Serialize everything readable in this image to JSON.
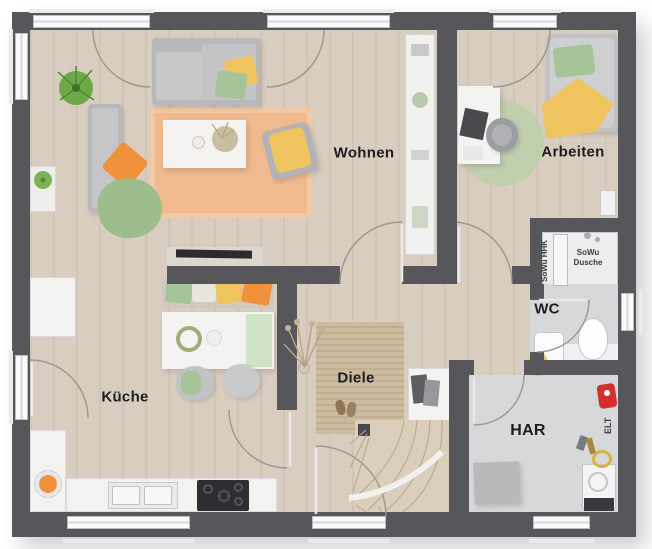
{
  "plan": {
    "type": "floor-plan",
    "language": "de"
  },
  "rooms": [
    {
      "id": "wohnen",
      "label": "Wohnen"
    },
    {
      "id": "arbeiten",
      "label": "Arbeiten"
    },
    {
      "id": "kueche",
      "label": "Küche"
    },
    {
      "id": "diele",
      "label": "Diele"
    },
    {
      "id": "wc",
      "label": "WC"
    },
    {
      "id": "har",
      "label": "HAR"
    }
  ],
  "annotations": {
    "shower_line1": "SoWu",
    "shower_line2": "Dusche",
    "radiator": "SoWu HHK",
    "electrical": "ELT"
  },
  "colors": {
    "wall": "#57575b",
    "floor-wood": "#d9cdc0",
    "floor-tile": "#d7d8da",
    "shower-floor": "#eceded",
    "rug-living": "#f0ba8e",
    "rug-hall": "#cdbb9f",
    "sofa-gray": "#b9b9bb",
    "accent-orange": "#f0913c",
    "accent-yellow": "#efc45f",
    "accent-green": "#a5c497",
    "plant-green": "#6fa848",
    "furniture-white": "#f4f3f1",
    "device-red": "#d2302c",
    "text": "#1d1d1f"
  }
}
